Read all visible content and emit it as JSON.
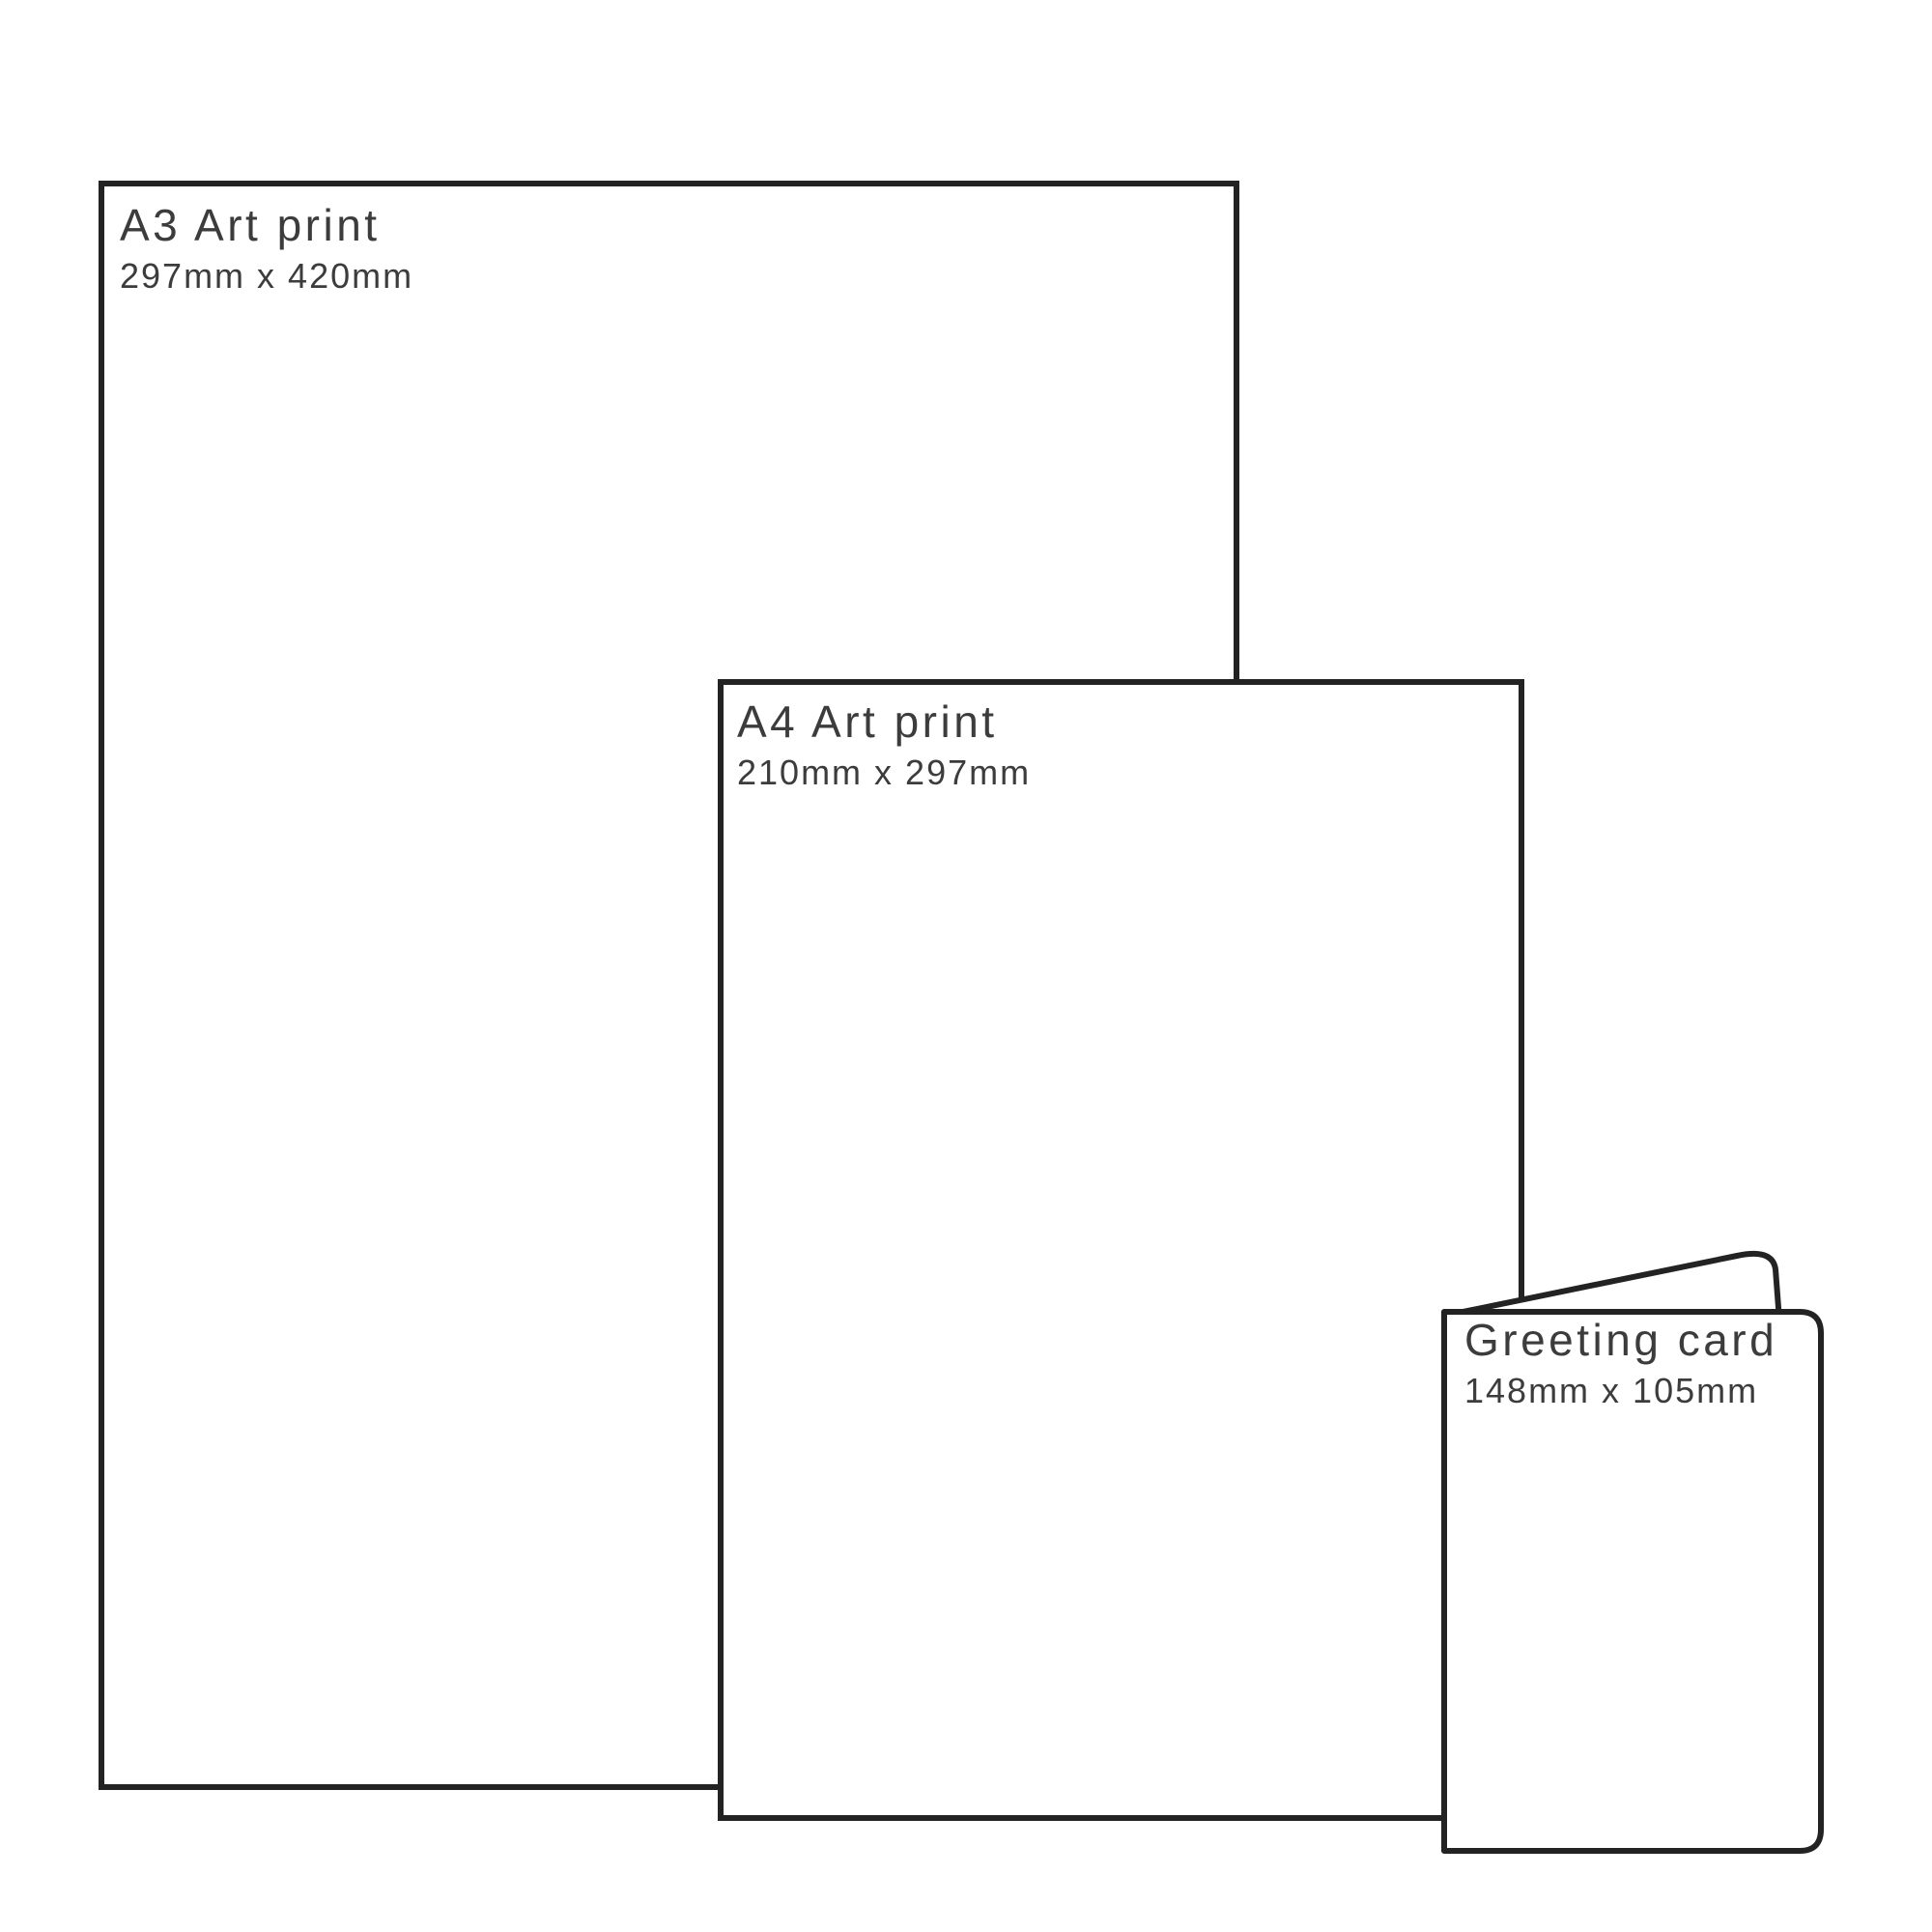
{
  "colors": {
    "outline": "#232323",
    "label": "#3c3c3c",
    "background": "#ffffff"
  },
  "items": [
    {
      "id": "a3-art-print",
      "label": "A3 Art print",
      "dimensions": "297mm x 420mm"
    },
    {
      "id": "a4-art-print",
      "label": "A4 Art print",
      "dimensions": "210mm x 297mm"
    },
    {
      "id": "greeting-card",
      "label": "Greeting card",
      "dimensions": "148mm x 105mm"
    }
  ]
}
